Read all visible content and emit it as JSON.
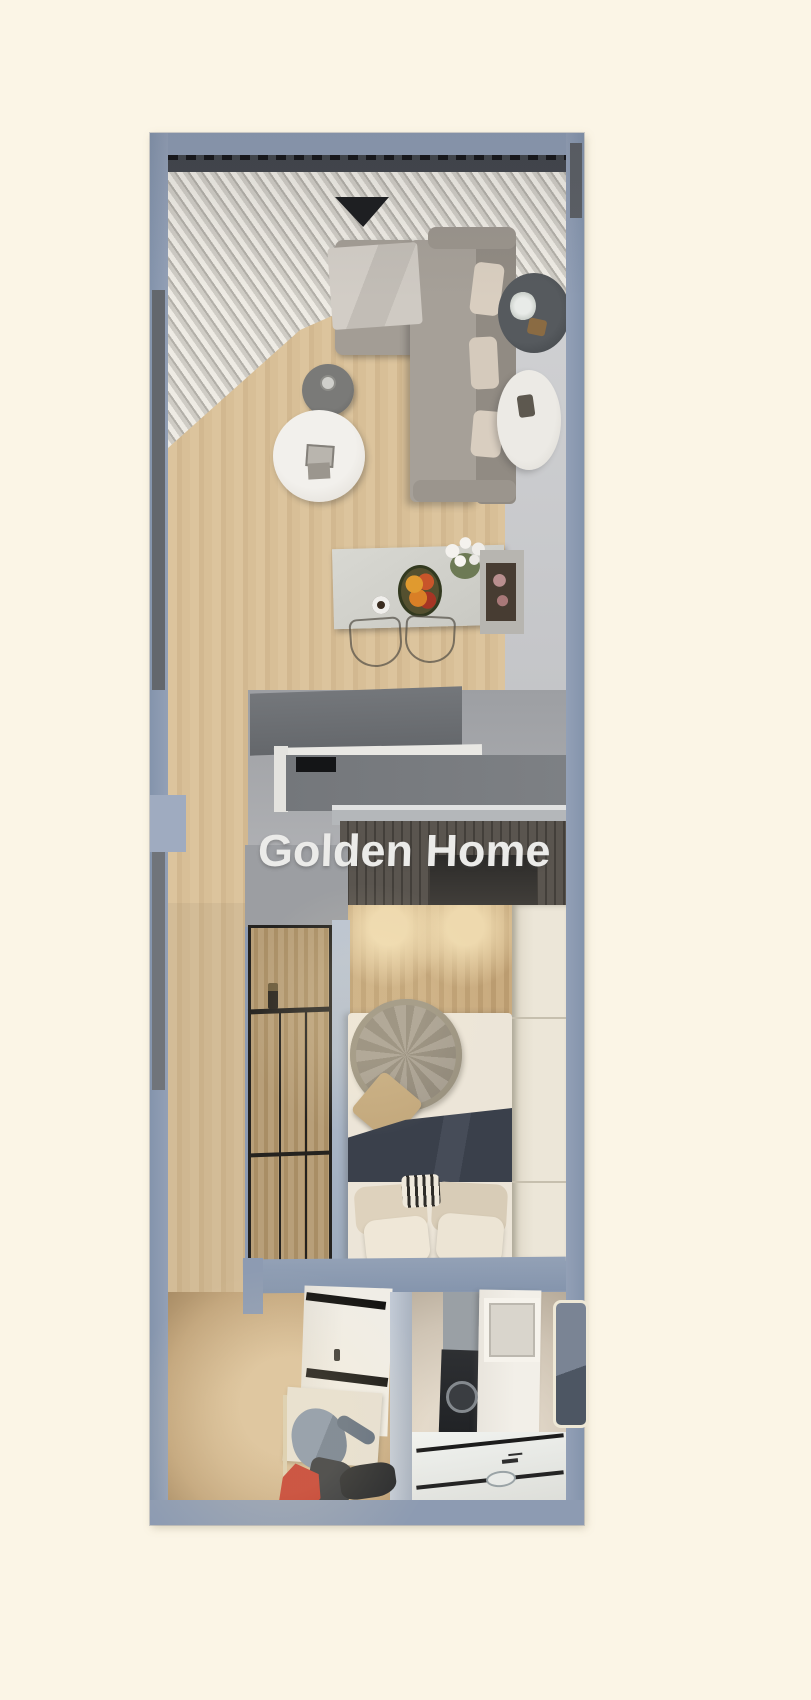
{
  "scene": {
    "type": "3d-floor-plan-render",
    "description": "Top-down 3D rendering of a narrow one-bedroom apartment unit",
    "watermark": {
      "text": "Golden Home"
    }
  },
  "palette": {
    "background": "#fbf5e6",
    "wall": "#8d9bb2",
    "wall_dark": "#63676d",
    "wall_light": "#9fabc0",
    "wood": "#d7be97",
    "wood_warm": "#c5a87e",
    "hall_gray": "#cbccce",
    "kitchen_gray": "#a2a4a8",
    "counter": "#6f7276",
    "counter_trim": "#e9e8e4",
    "wardrobe": "#544f49",
    "sofa": "#a39d95",
    "sofa_back": "#918b83",
    "pillow": "#d9cec0",
    "mattress": "#ece5d8",
    "duvet_navy": "#3d434e",
    "throw_knit": "#9e9689",
    "table_white": "#efedea",
    "table_dark": "#6f6f6d",
    "dining_table": "#d3d3cd",
    "accent_red": "#c23b2c",
    "accent_blue": "#7b8a9d",
    "watermark_color": "#ebebe9"
  },
  "rooms": [
    {
      "name": "balcony-with-curtains"
    },
    {
      "name": "living-room"
    },
    {
      "name": "dining-area"
    },
    {
      "name": "kitchen-pass"
    },
    {
      "name": "bedroom"
    },
    {
      "name": "walk-in-closet"
    },
    {
      "name": "bathroom"
    }
  ],
  "furniture": [
    "pleated-curtains",
    "sectional-sofa",
    "throw-blanket",
    "wall-planter",
    "round-side-table",
    "dark-coffee-table",
    "white-coffee-table",
    "magazine",
    "dining-table",
    "fruit-platter",
    "coffee-cup",
    "flower-vase",
    "sideboard-niche",
    "dining-chairs",
    "kitchen-counter",
    "cooktop-inset",
    "wardrobe",
    "glass-partition",
    "candle-holder",
    "double-bed",
    "knit-round-throw",
    "tan-cushion",
    "navy-duvet",
    "bed-pillows",
    "built-in-closet-column",
    "shoe-cabinet",
    "clothes-rail",
    "blue-jacket",
    "dark-pants",
    "red-shirt",
    "washing-machine",
    "laundry-cabinet",
    "led-mirror",
    "vanity-counter",
    "sink"
  ]
}
